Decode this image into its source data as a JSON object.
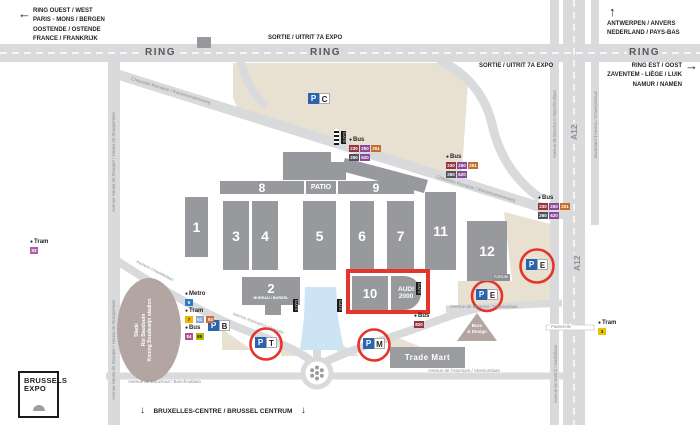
{
  "corners": {
    "nw": [
      "RING OUEST / WEST",
      "PARIS - MONS / BERGEN",
      "OOSTENDE / OSTENDE",
      "FRANCE / FRANKRIJK"
    ],
    "ne_north": [
      "ANTWERPEN / ANVERS",
      "NEDERLAND / PAYS-BAS"
    ],
    "ne_east": [
      "RING EST / OOST",
      "ZAVENTEM - LIÈGE / LUIK",
      "NAMUR / NAMEN"
    ],
    "south": "BRUXELLES-CENTRE / BRUSSEL CENTRUM"
  },
  "roads": {
    "ring": "RING",
    "a12": "A12",
    "sortie": "SORTIE / UITRIT 7A EXPO",
    "chaussee": "Chaussée Romaine / Romeinsesteenweg",
    "houba": "Avenue Houba de Strooper / Houba de Strooperlaan",
    "bouchout_v": "Avenue de Bouchout / Boechoutlaan",
    "anvers": "Boulevard d'Anvers / Antwerpselaan",
    "madrid": "Avenue de Madrid / Madridlaan",
    "miramar": "Avenue de Miramar / Miramarlaan",
    "charlotte_fr": "Avenue Impératrice Charlotte",
    "charlotte_nl": "Keizerin Charlottelaan",
    "bouchout_b": "Avenue de Bouchout / Boechoutlaan",
    "atomium": "Avenue de l'Atomium / Atomiumlaan",
    "passerelle": "Passerelle"
  },
  "halls": {
    "h1": "1",
    "h2": "2",
    "h3": "3",
    "h4": "4",
    "h5": "5",
    "h6": "6",
    "h7": "7",
    "h8": "8",
    "h9": "9",
    "h10": "10",
    "h11": "11",
    "h12": "12",
    "patio": "PATIO",
    "audi1": "AUDI",
    "audi2": "2000",
    "bureau": "BUREAU / BUREEL"
  },
  "places": {
    "trade_mart": "Trade Mart",
    "stadium1": "Stade",
    "stadium2": "Roi Baudouin",
    "stadium3": "Koning Boudewijn stadion",
    "buro1": "Buro",
    "buro2": "& Design",
    "gate": "GATE",
    "forum": "FORUM"
  },
  "parking": {
    "p": "P",
    "c": "C",
    "e": "E",
    "t": "T",
    "m": "M",
    "b": "B"
  },
  "transit": {
    "bus": "Bus",
    "tram": "Tram",
    "metro": "Metro",
    "delijn_r1": [
      "230",
      "250",
      "251"
    ],
    "delijn_r2": [
      "260",
      "620"
    ],
    "bus_single": "820",
    "metro_line": "6",
    "tram_lines": [
      "7",
      "51",
      "93"
    ],
    "stib_bus_lines": [
      "84",
      "88"
    ],
    "tram_left": "93",
    "tram_right": "3"
  },
  "logo": {
    "l1": "BRUSSELS",
    "l2": "EXPO"
  },
  "icons": {
    "arrow_left": "←",
    "arrow_up": "↑",
    "arrow_right": "→",
    "arrow_down": "↓",
    "dot": "●"
  },
  "colors": {
    "highlight_red": "#e5342a",
    "parking_blue": "#2a64ad",
    "road_gray": "#d9dadb",
    "building_gray": "#97999c",
    "beige": "#e8e0d1",
    "pond_blue": "#cde4f4",
    "mauve": "#b2a5a2"
  }
}
